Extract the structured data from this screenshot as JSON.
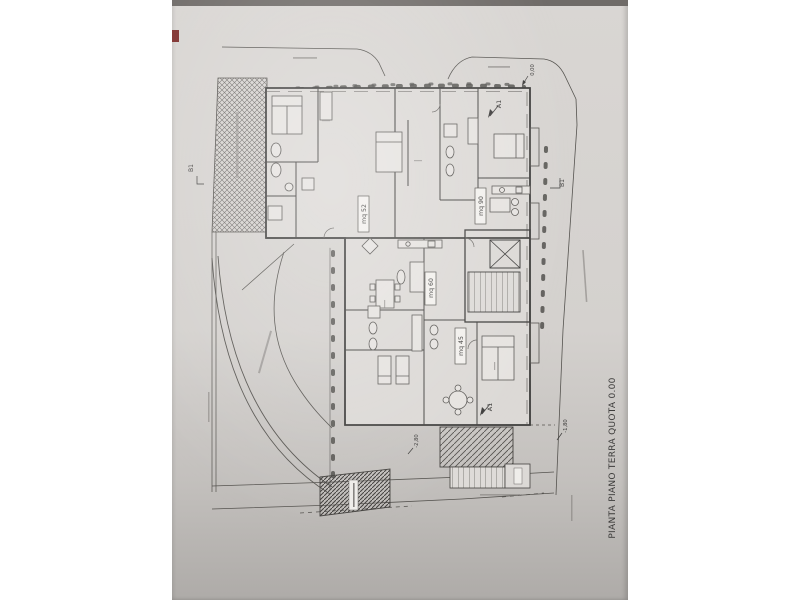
{
  "photo": {
    "paper_color": "#d9d6d3",
    "paper_shadow_color": "#aeaba8",
    "top_edge_color": "#6f6b68",
    "red_mark_color": "#7e2f2c",
    "line_color": "#4a4947"
  },
  "title": {
    "text": "PIANTA PIANO TERRA QUOTA 0.00"
  },
  "apartments": [
    {
      "id": "apt-52",
      "label": "mq 52"
    },
    {
      "id": "apt-90",
      "label": "mq 90"
    },
    {
      "id": "apt-60",
      "label": "mq 60"
    },
    {
      "id": "apt-45",
      "label": "mq 45"
    }
  ],
  "markers": {
    "section_a_top": "A1",
    "section_a_bottom": "A1",
    "section_b_left": "B1",
    "section_b_right": "B1"
  },
  "quotas": {
    "street_level": "0,00",
    "minus_180": "-1,80",
    "minus_280": "-2,80"
  }
}
